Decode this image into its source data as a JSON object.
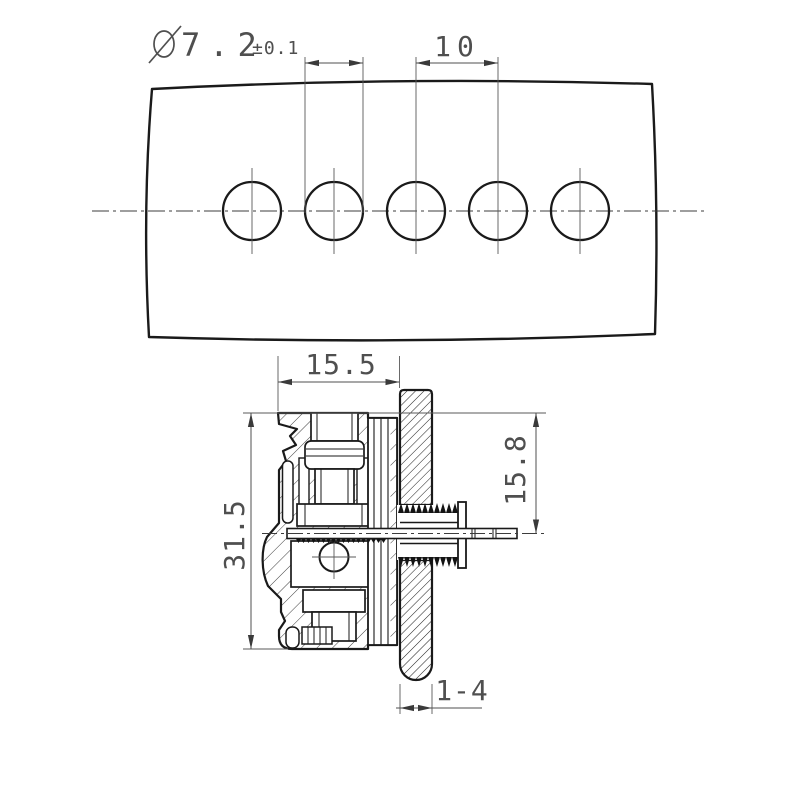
{
  "drawing": {
    "type": "technical-engineering-drawing",
    "background_color": "#ffffff",
    "outline_color": "#1a1a1a",
    "dimension_color": "#4f4f4f"
  },
  "top_view": {
    "description": "panel front view with 5 mounting holes on a centerline",
    "hole_count": "5",
    "hole_diameter_symbol": "Ø",
    "hole_diameter_value": "7.2",
    "hole_diameter_tolerance": "±0.1",
    "hole_spacing": "10"
  },
  "section_view": {
    "description": "connector cross-section mounted through panel",
    "body_width": "15.5",
    "body_height": "31.5",
    "center_height": "15.8",
    "panel_thickness": "1-4"
  }
}
